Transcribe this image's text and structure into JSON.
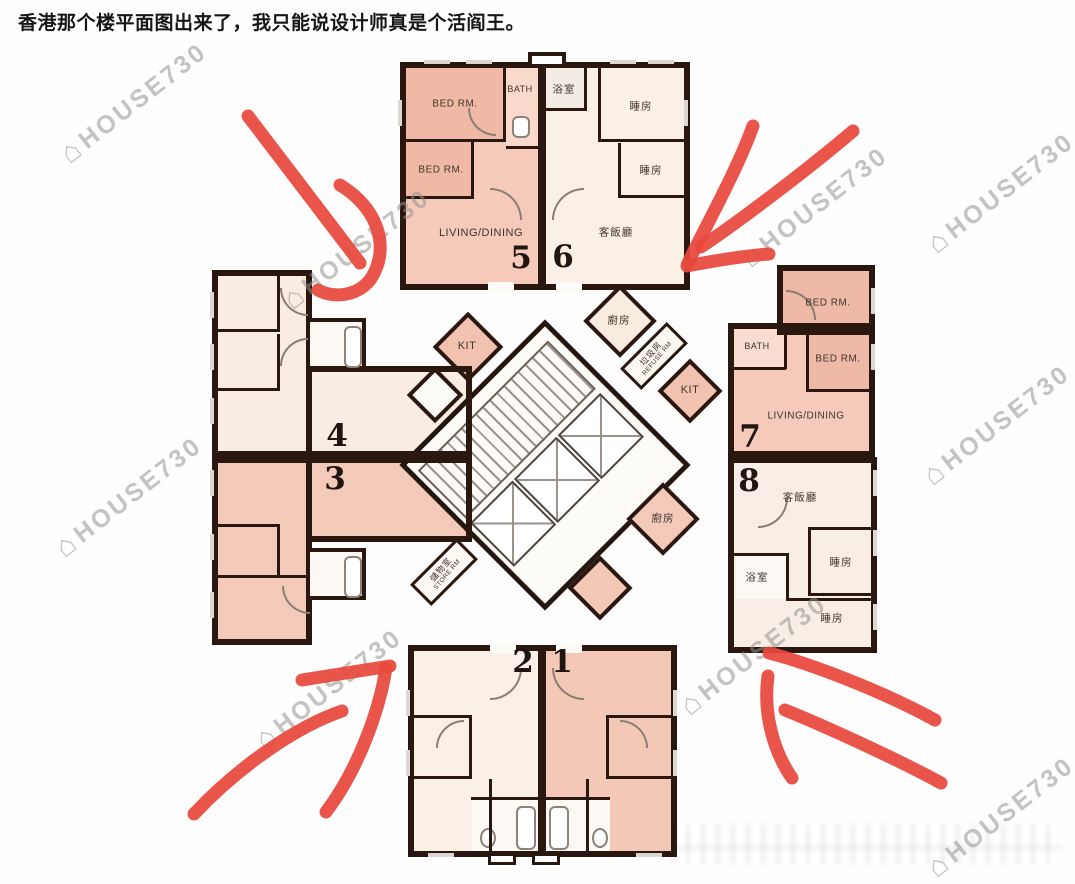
{
  "caption": "香港那个楼平面图出来了，我只能说设计师真是个活阎王。",
  "watermark": {
    "brand": "HOUSE730",
    "icon_glyph": "⌂",
    "icon_name": "house-icon"
  },
  "plan": {
    "unit_numbers": {
      "u1": "1",
      "u2": "2",
      "u3": "3",
      "u4": "4",
      "u5": "5",
      "u6": "6",
      "u7": "7",
      "u8": "8"
    },
    "unit5": {
      "bed1": "BED RM.",
      "bath": "BATH",
      "bed2": "BED RM.",
      "living": "LIVING/DINING",
      "kitchen": "KIT"
    },
    "unit6": {
      "bath": "浴室",
      "bed1": "睡房",
      "bed2": "睡房",
      "living": "客飯廳",
      "kitchen": "廚房"
    },
    "unit7": {
      "bed1": "BED RM.",
      "bath": "BATH",
      "bed2": "BED RM.",
      "living": "LIVING/DINING",
      "kitchen": "KIT"
    },
    "unit8": {
      "living": "客飯廳",
      "bed1": "睡房",
      "bath": "浴室",
      "bed2": "睡房",
      "kitchen": "廚房"
    },
    "core": {
      "refuse_zh": "垃圾房",
      "refuse_en": "REFUSE RM",
      "store_zh": "儲物室",
      "store_en": "STORE RM"
    }
  },
  "annotation_arrows": {
    "color": "#e7483c",
    "count": 4,
    "positions": [
      "top-left",
      "top-right",
      "bottom-left",
      "bottom-right"
    ]
  }
}
